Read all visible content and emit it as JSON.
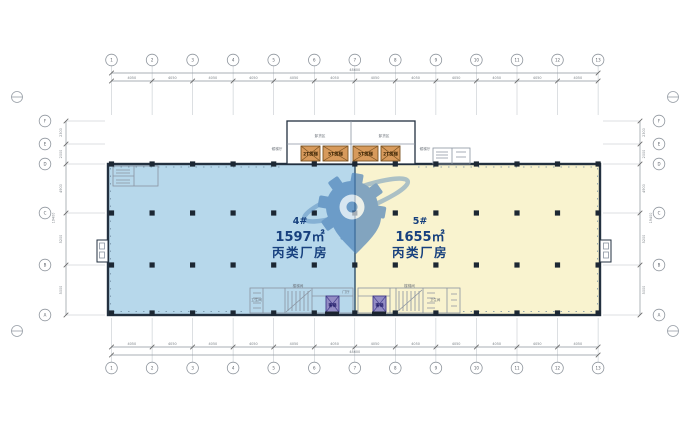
{
  "drawing": {
    "zones": [
      {
        "id": "4#",
        "area": "1597㎡",
        "type": "丙类厂房"
      },
      {
        "id": "5#",
        "area": "1655㎡",
        "type": "丙类厂房"
      }
    ],
    "core": {
      "freight_elevators": [
        "2T货梯",
        "5T货梯",
        "5T货梯",
        "2T货梯"
      ],
      "rooms": [
        "卸货区",
        "卸货区"
      ],
      "side_labels": [
        "候梯厅",
        "候梯厅"
      ]
    },
    "bottom_rooms": {
      "passenger_elevators": [
        "客梯",
        "客梯"
      ],
      "labels": [
        "卫生间",
        "楼梯间",
        "门厅",
        "楼梯间",
        "卫生间"
      ]
    },
    "axes": {
      "cols": [
        "1",
        "2",
        "3",
        "4",
        "5",
        "6",
        "7",
        "8",
        "9",
        "10",
        "11",
        "12",
        "13"
      ],
      "rows": [
        "F",
        "E",
        "D",
        "C",
        "B",
        "A"
      ]
    },
    "dims": {
      "top_segments": [
        "4050",
        "4050",
        "4050",
        "4050",
        "4050",
        "4050",
        "4050",
        "4050",
        "4050",
        "4050",
        "4050",
        "4050"
      ],
      "top_total": "48600",
      "bottom_segments": [
        "4050",
        "4050",
        "4050",
        "4050",
        "4050",
        "4050",
        "4050",
        "4050",
        "4050",
        "4050",
        "4050",
        "4050"
      ],
      "bottom_total": "48600",
      "left_segments": [
        "2300",
        "2000",
        "4900",
        "5200",
        "5000"
      ],
      "left_total": "19400",
      "right_segments": [
        "2300",
        "2000",
        "4900",
        "5200",
        "5000"
      ],
      "right_total": "19400"
    },
    "colors": {
      "zone_blue": "#b7d8eb",
      "zone_yellow": "#f9f3cf",
      "wall": "#233140",
      "label": "#17407e",
      "freight": "#d79a5c",
      "freight_border": "#7a5322",
      "passenger": "#938cc4",
      "passenger_border": "#413a8a",
      "watermark": "#4a80b8",
      "line": "#8a93a0"
    }
  }
}
